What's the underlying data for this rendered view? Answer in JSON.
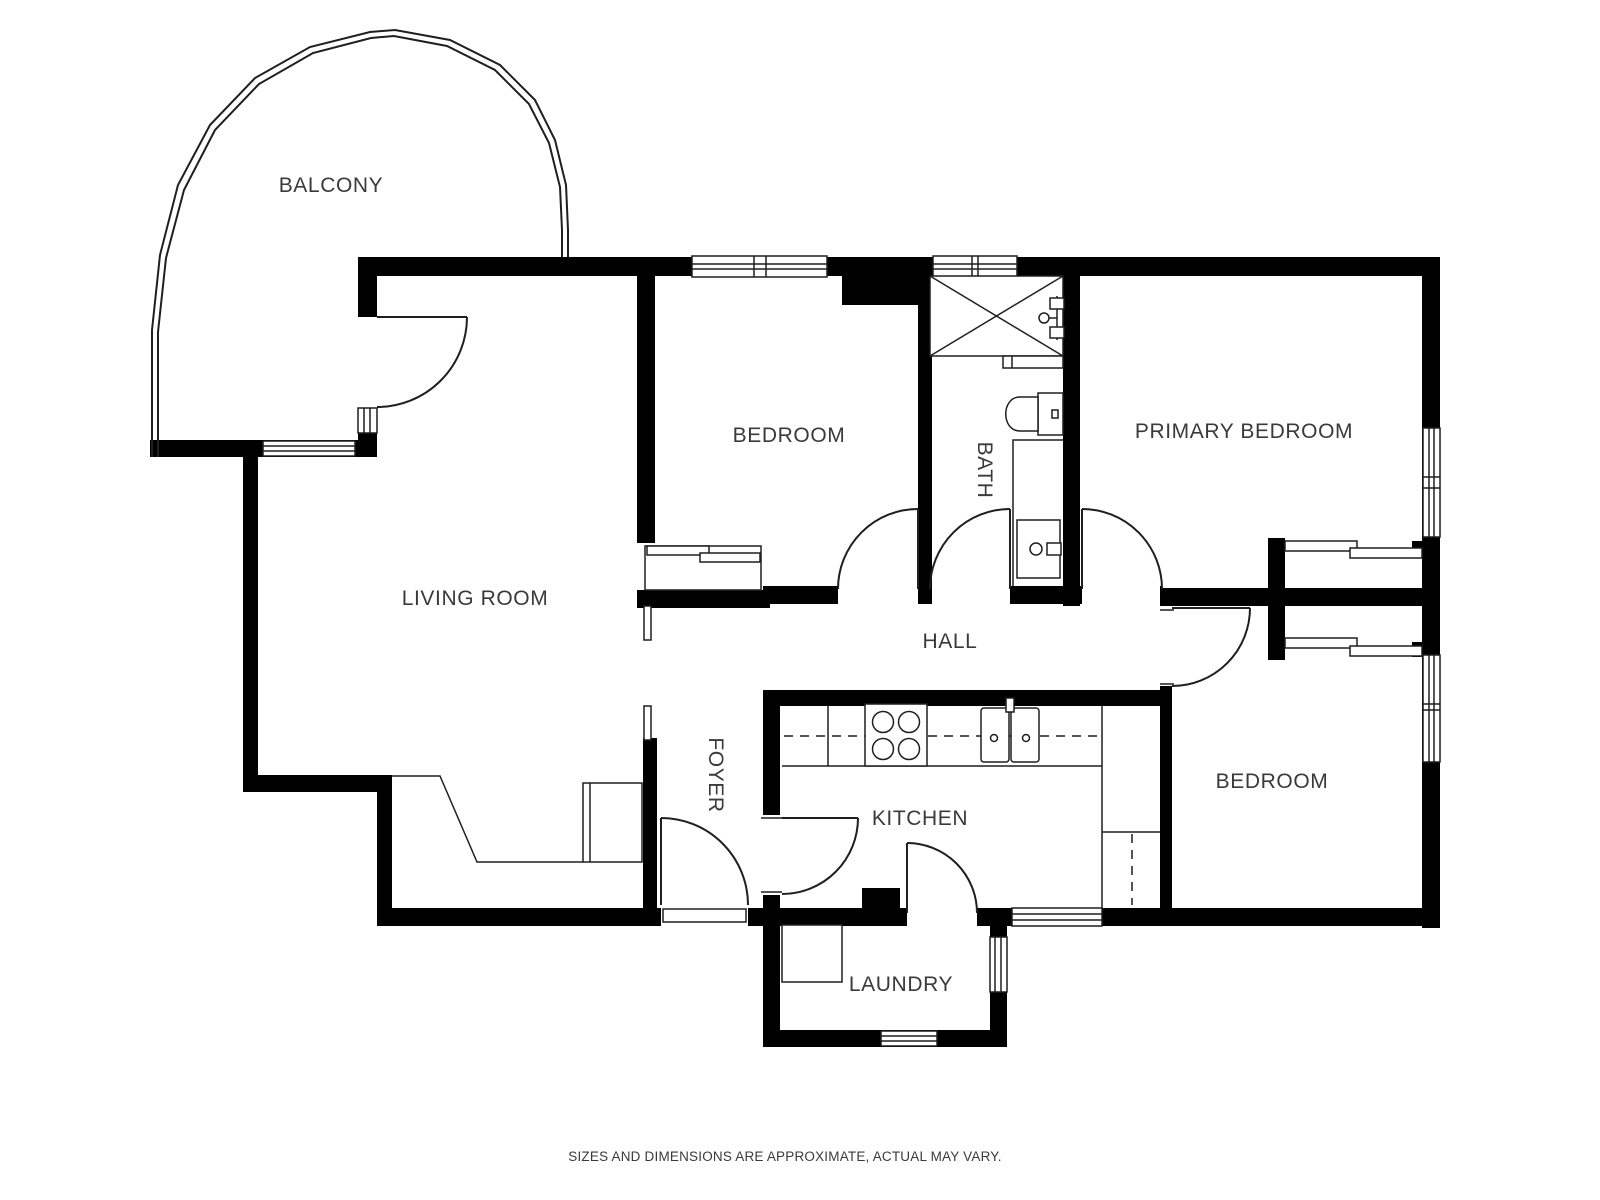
{
  "plan": {
    "rooms": {
      "balcony": "BALCONY",
      "living_room": "LIVING ROOM",
      "bedroom": "BEDROOM",
      "bath": "BATH",
      "primary_bedroom": "PRIMARY BEDROOM",
      "hall": "HALL",
      "foyer": "FOYER",
      "kitchen": "KITCHEN",
      "bedroom2": "BEDROOM",
      "laundry": "LAUNDRY"
    },
    "fixtures": [
      "shower",
      "shower-valve",
      "shower-bench",
      "toilet",
      "vanity-sink",
      "stove",
      "kitchen-sink",
      "refrigerator-space",
      "kitchen-counter",
      "sliding-closet-bedroom",
      "sliding-closet-primary",
      "sliding-closet-bedroom2",
      "coat-closet",
      "utility-closet",
      "entry-door",
      "balcony-door"
    ],
    "colors": {
      "wall": "#000000",
      "line": "#1f1f1f",
      "label": "#3a3a3a",
      "background": "#ffffff"
    }
  },
  "footer": {
    "disclaimer": "SIZES AND DIMENSIONS ARE APPROXIMATE, ACTUAL MAY VARY."
  }
}
